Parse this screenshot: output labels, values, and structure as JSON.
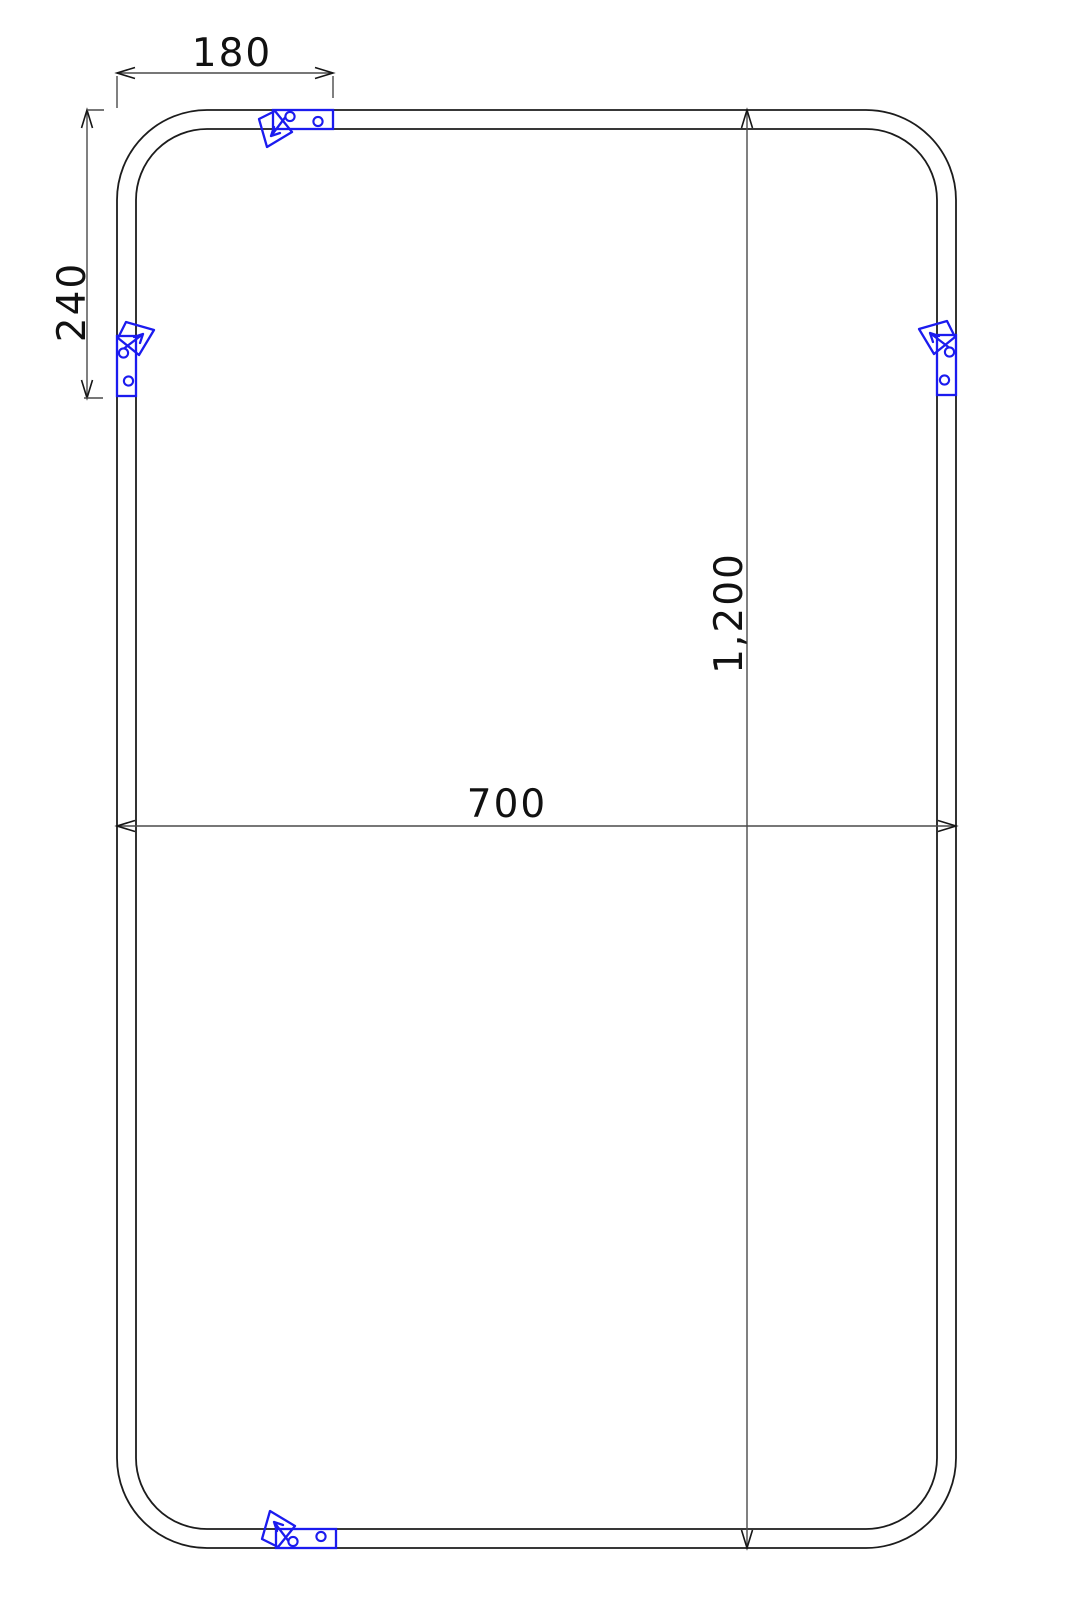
{
  "drawing": {
    "title": "rounded-rectangle frame dimension drawing",
    "dimensions": {
      "top_width": {
        "label": "180"
      },
      "left_height": {
        "label": "240"
      },
      "overall_width": {
        "label": "700"
      },
      "overall_height": {
        "label": "1,200"
      }
    },
    "clips": {
      "symbol": "mounting-clip-icon",
      "positions": [
        "top",
        "left",
        "right",
        "bottom"
      ],
      "holes_per_clip": 2
    },
    "colors": {
      "background": "#ffffff",
      "outline": "#1c1c1c",
      "dimension_line": "#4a4a4a",
      "text": "#111111",
      "clip_blue": "#1b1bef"
    }
  }
}
